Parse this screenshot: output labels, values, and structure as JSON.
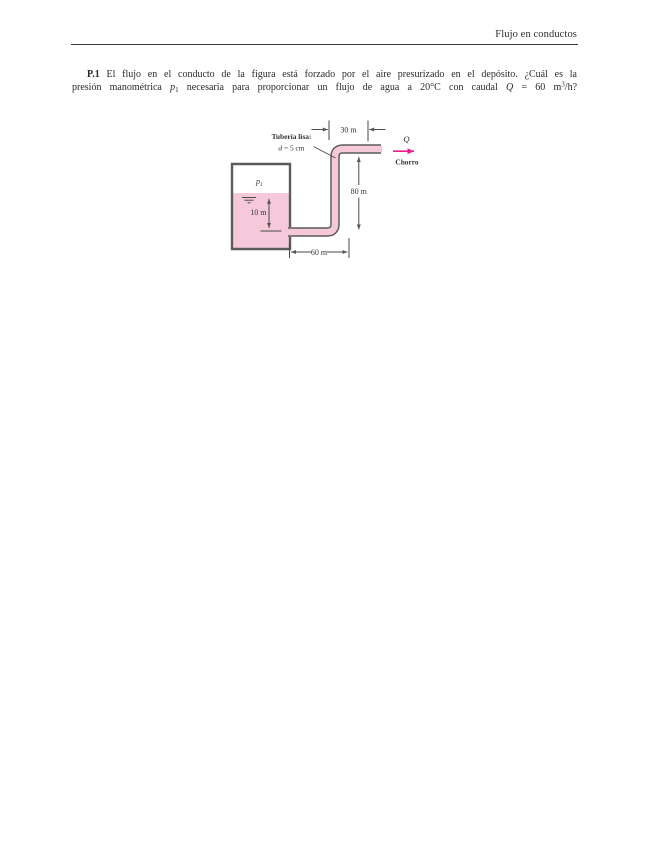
{
  "header": {
    "title": "Flujo en conductos"
  },
  "problem": {
    "number": "P.1",
    "line1_rest": " El flujo en el conducto de la figura está forzado por el aire presurizado en el depósito. ¿Cuál es la",
    "line2_a": "presión manométrica ",
    "p_var": "p",
    "p_sub": "1",
    "line2_b": " necesaria para proporcionar un flujo de agua a 20°C con caudal ",
    "q_var": "Q",
    "line2_c": " = 60 m",
    "m_sup": "3",
    "line2_d": "/h?"
  },
  "figure": {
    "pipe_type_label": "Tubería lisa:",
    "pipe_diameter_var": "d",
    "pipe_diameter_rest": " = 5 cm",
    "dim_top_run": "30 m",
    "dim_riser": "80 m",
    "dim_bottom_run": "60 m",
    "dim_depth": "10 m",
    "air_pressure_var": "p",
    "air_pressure_sub": "1",
    "flow_symbol": "Q",
    "jet_label": "Chorro",
    "colors": {
      "water": "#f5c9da",
      "ink": "#555555",
      "flow_arrow": "#ed1c8f"
    }
  }
}
